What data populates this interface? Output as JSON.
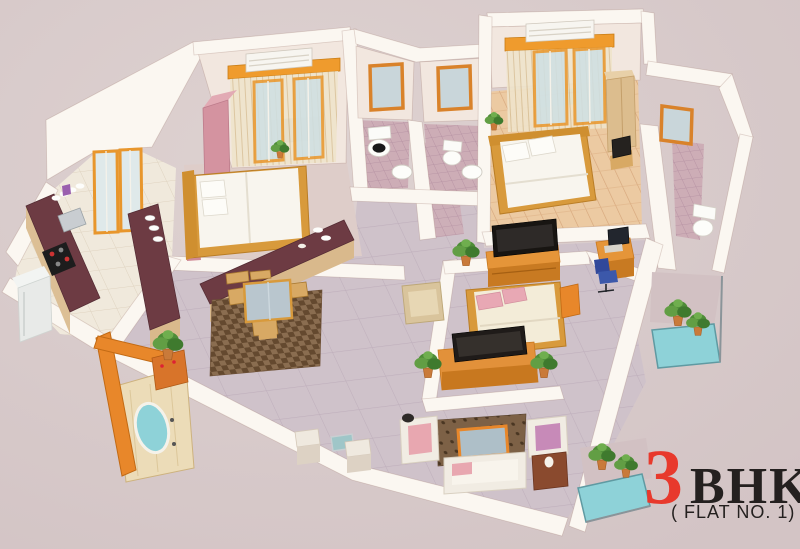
{
  "title": {
    "number": "3",
    "unit": "BHK",
    "subtitle": "( FLAT NO. 1)"
  },
  "colors": {
    "background": "#d8caca",
    "wall_white": "#fbf7f1",
    "wall_face_cream": "#f2e7df",
    "accent_orange": "#ef9b2d",
    "door_frame_orange": "#e8872a",
    "balcony_aqua": "#8ed2d8",
    "kitchen_counter_maroon": "#6d3b43",
    "wood_floor": "#eccaa2",
    "bathroom_tile_mauve": "#cdadb6",
    "hall_floor": "#cfc2ca",
    "bed_frame_gold": "#d89a3c",
    "wardrobe_pink": "#d493a0",
    "plant_green": "#4e8c38",
    "title_red": "#e8392c",
    "title_black": "#24201f"
  },
  "regions": [
    "bedroom-1",
    "kitchen",
    "dining-area",
    "living-hall",
    "entrance-foyer",
    "bathroom-1",
    "bathroom-2",
    "master-bedroom",
    "attached-bathroom",
    "bedroom-3",
    "study-corner",
    "balcony-right",
    "balcony-bottom"
  ]
}
